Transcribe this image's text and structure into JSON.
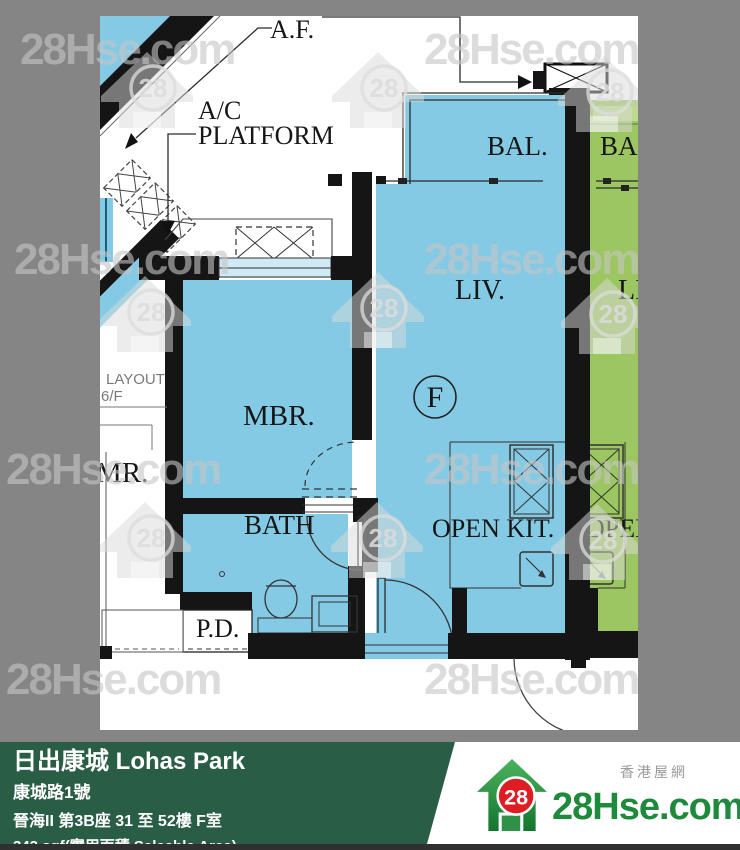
{
  "watermark": {
    "text": "28Hse.com",
    "badge": "28"
  },
  "plan": {
    "labels": {
      "af": "A.F.",
      "ac_line1": "A/C",
      "ac_line2": "PLATFORM",
      "bal": "BAL.",
      "liv": "LIV.",
      "unit": "F",
      "mbr": "MBR.",
      "bath": "BATH",
      "open_kit": "OPEN KIT.",
      "pd": "P.D.",
      "layout": "LAYOUT",
      "floor": "6/F",
      "mr": "MR.",
      "neighbor_bal": "BAL",
      "neighbor_liv": "LI",
      "neighbor_open": "OPEN"
    },
    "colors": {
      "unit": "#85CAE4",
      "neighbor": "#9CC661",
      "wall": "#151515",
      "page": "#FFFFFF",
      "backdrop": "#858585"
    }
  },
  "footer": {
    "title": "日出康城 Lohas Park",
    "address": "康城路1號",
    "block": "晉海II 第3B座 31 至 52樓 F室",
    "area": "343 sqf(實用面積 Saleable Area)",
    "bar_color": "#2A5D45"
  },
  "brand": {
    "site_cn": "香港屋網",
    "logo_text": "28Hse.com",
    "logo_badge": "28",
    "green": "#1E8A3C",
    "red": "#DD1C23"
  }
}
